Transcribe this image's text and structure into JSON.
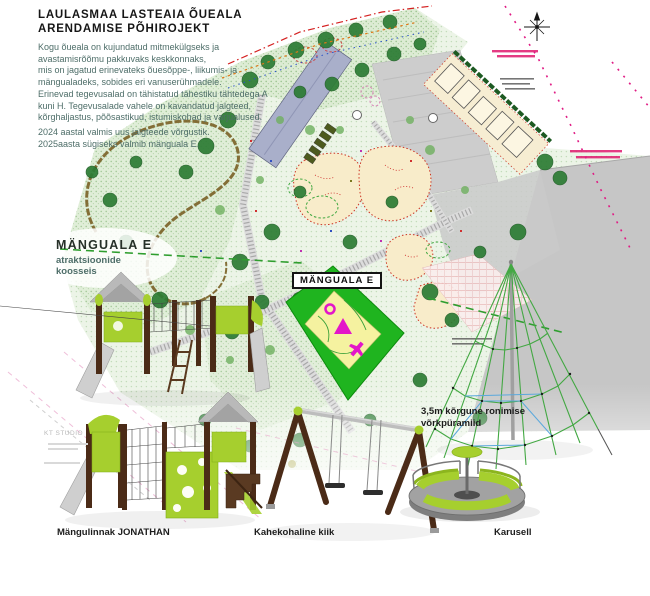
{
  "page": {
    "title_line1": "LAULASMAA LASTEAIA ÕUEALA",
    "title_line2": "ARENDAMISE PÕHIROJEKT"
  },
  "intro": {
    "para1": "Kogu õueala on kujundatud mitmekülgseks ja\navastamisrõõmu pakkuvaks keskkonnaks,\nmis on jagatud erinevateks õuesõppe-, liikumis- ja\nmängualadeks, sobides eri vanuserühmadele.",
    "para2": "Erinevad tegevusalad on tähistatud tähestiku tähtedega A\nkuni H. Tegevusalade vahele on kavandatud jalgteed,\nkõrghaljastus, põõsastikud, istumiskohad ja varjualused.",
    "para3": "2024 aastal valmis uus jalgteede võrgustik.\n2025aasta sügiseks valmib mänguala E."
  },
  "manguala": {
    "heading": "MÄNGUALA E",
    "subheading": "atraktsioonide\nkoosseis",
    "map_label": "MÄNGUALA E"
  },
  "equipment": {
    "pyramid_label": "3,5m kõrgune ronimise\nvõrkpüramiid",
    "playhouse_label": "Mängulinnak JONATHAN",
    "swing_label": "Kahekohaline kiik",
    "carousel_label": "Karusell"
  },
  "watermark": "KT STUDIO",
  "colors": {
    "accent_green": "#1fb41f",
    "lime": "#a6cf2e",
    "wood": "#4b2b17",
    "teal_text": "#4e6e69",
    "map_magenta": "#e01b84",
    "icon_magenta": "#e316c9"
  }
}
